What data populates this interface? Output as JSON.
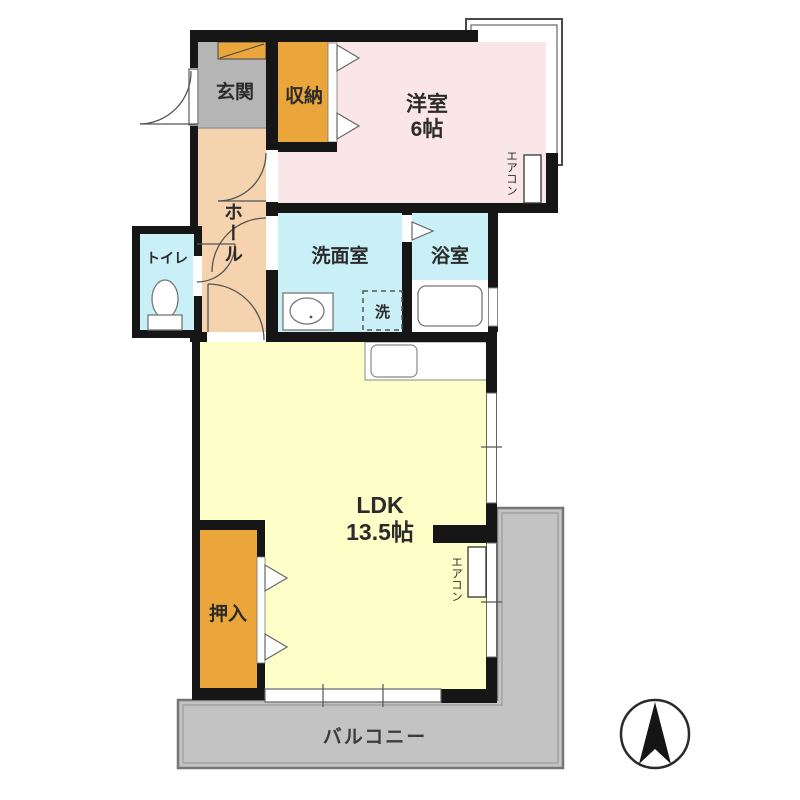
{
  "title": "apartment-floor-plan",
  "rooms": {
    "entrance": {
      "label": "玄関"
    },
    "storage": {
      "label": "収納"
    },
    "western_room": {
      "label": "洋室",
      "size": "6帖"
    },
    "hall": {
      "label": "ホール"
    },
    "toilet": {
      "label": "トイレ"
    },
    "washroom": {
      "label": "洗面室"
    },
    "bathroom": {
      "label": "浴室"
    },
    "washer_space": {
      "label": "洗"
    },
    "ldk": {
      "label": "LDK",
      "size": "13.5帖"
    },
    "closet": {
      "label": "押入"
    },
    "balcony": {
      "label": "バルコニー"
    }
  },
  "equipment": {
    "aircon_label": "エアコン"
  },
  "icons": {
    "compass": "north-arrow-icon",
    "toilet": "toilet-icon",
    "washbasin": "washbasin-icon",
    "bathtub": "bathtub-icon",
    "kitchen_sink": "kitchen-sink-icon",
    "door_arcs": "door-swing-icon",
    "closet_doors": "folding-door-triangle-icon"
  },
  "colors": {
    "wall": "#161616",
    "entrance_floor": "#b5b5b5",
    "hall_floor": "#f4d3ae",
    "western_room_floor": "#fae5e8",
    "wet_area_floor": "#c9f0f6",
    "ldk_floor": "#feffc8",
    "closet_storage": "#eaa63a",
    "balcony": "#c3c3c3"
  }
}
